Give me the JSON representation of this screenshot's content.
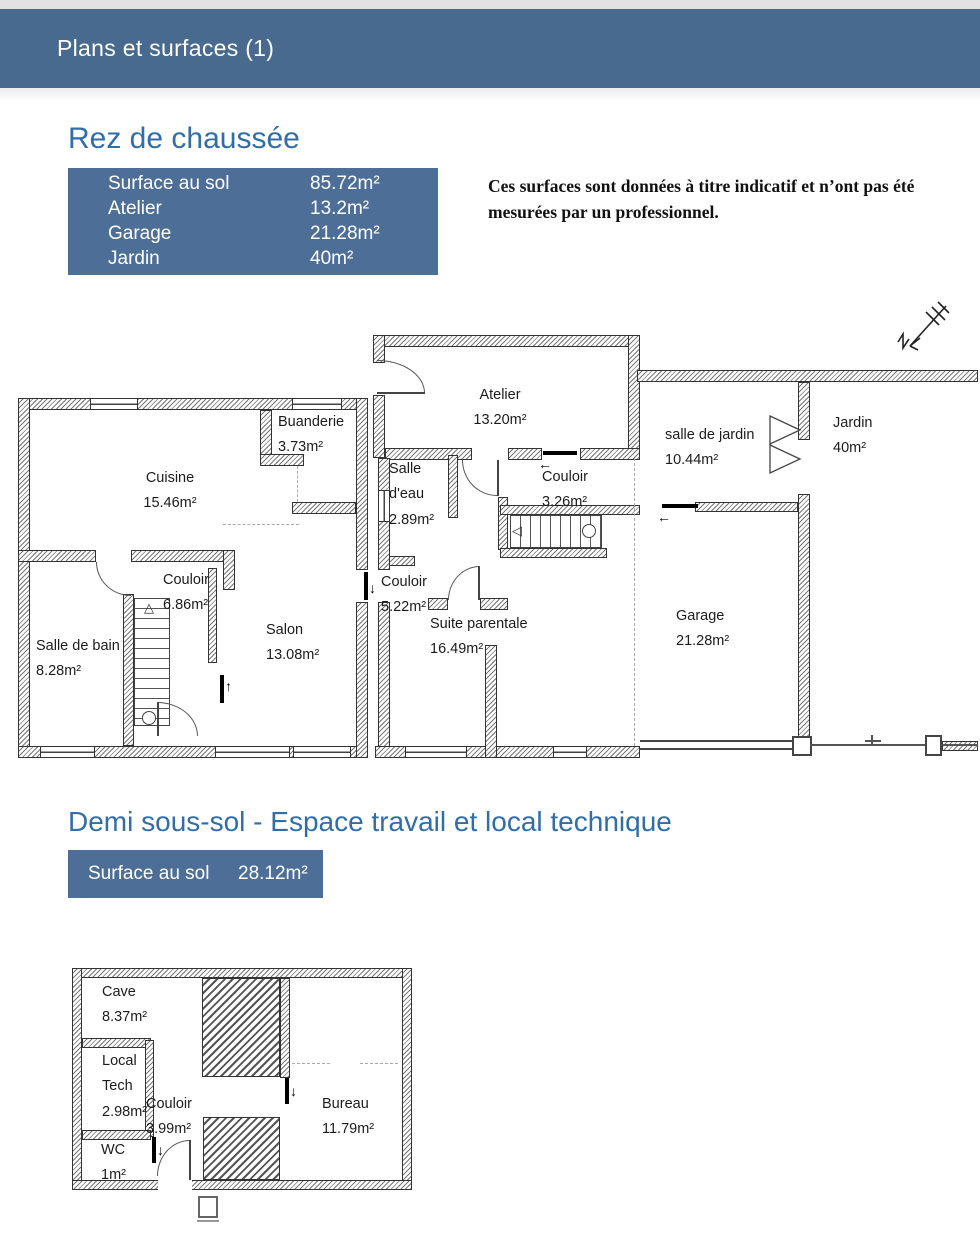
{
  "page": {
    "title": "Plans et surfaces (1)"
  },
  "colors": {
    "header_bg": "#476a8e",
    "table_bg": "#4d6f97",
    "title_text": "#2f6ea9"
  },
  "rdc": {
    "title": "Rez de chaussée",
    "surfaces": [
      {
        "label": "Surface au sol",
        "value": "85.72m²"
      },
      {
        "label": "Atelier",
        "value": "13.2m²"
      },
      {
        "label": "Garage",
        "value": "21.28m²"
      },
      {
        "label": "Jardin",
        "value": "40m²"
      }
    ],
    "note": "Ces surfaces sont données à titre indicatif et n’ont pas été mesurées par un professionnel.",
    "rooms": {
      "cuisine": {
        "name": "Cuisine",
        "area": "15.46m²"
      },
      "buanderie": {
        "name": "Buanderie",
        "area": "3.73m²"
      },
      "atelier": {
        "name": "Atelier",
        "area": "13.20m²"
      },
      "salle_deau": {
        "name": "Salle d'eau",
        "area": "2.89m²"
      },
      "couloir_haut": {
        "name": "Couloir",
        "area": "3.26m²"
      },
      "salle_de_jardin": {
        "name": "salle de jardin",
        "area": "10.44m²"
      },
      "jardin": {
        "name": "Jardin",
        "area": "40m²"
      },
      "couloir_gauche": {
        "name": "Couloir",
        "area": "6.86m²"
      },
      "salle_de_bain": {
        "name": "Salle de bain",
        "area": "8.28m²"
      },
      "salon": {
        "name": "Salon",
        "area": "13.08m²"
      },
      "couloir_bas": {
        "name": "Couloir",
        "area": "5.22m²"
      },
      "suite_parentale": {
        "name": "Suite parentale",
        "area": "16.49m²"
      },
      "garage": {
        "name": "Garage",
        "area": "21.28m²"
      }
    }
  },
  "soussol": {
    "title": "Demi sous-sol - Espace travail et local technique",
    "surfaces": [
      {
        "label": "Surface au sol",
        "value": "28.12m²"
      }
    ],
    "rooms": {
      "cave": {
        "name": "Cave",
        "area": "8.37m²"
      },
      "local_tech": {
        "name": "Local Tech",
        "area": "2.98m²"
      },
      "couloir": {
        "name": "Couloir",
        "area": "3.99m²"
      },
      "wc": {
        "name": "WC",
        "area": "1m²"
      },
      "bureau": {
        "name": "Bureau",
        "area": "11.79m²"
      }
    }
  }
}
